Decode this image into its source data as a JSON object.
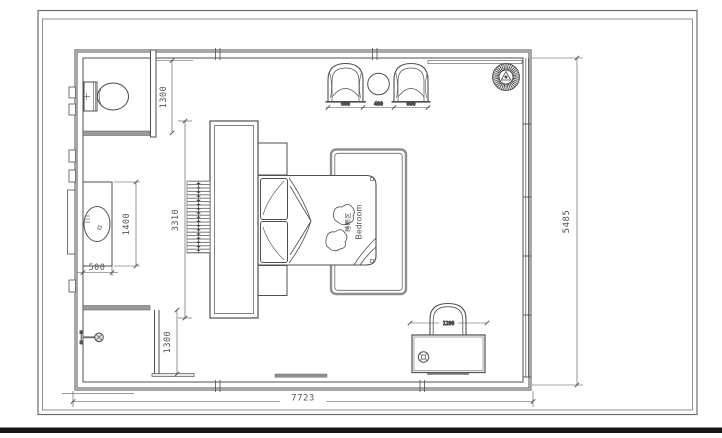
{
  "plan": {
    "room_label": {
      "zh": "睡眠区",
      "en": "Bedroom"
    },
    "dimensions": {
      "overall_width": "7723",
      "overall_height": "5485",
      "wc_depth": "1300",
      "shower_depth": "1300",
      "vanity_length": "1400",
      "vanity_depth": "500",
      "headboard_wall_length": "3310",
      "armchair_left_width": "600",
      "side_table_width": "400",
      "armchair_right_width": "600",
      "desk_width": "1200"
    },
    "colors": {
      "line": "#4f4f4f",
      "threshold": "#9a9a9a",
      "rug_border": "#8f8f8f",
      "bottom_bar": "#161616"
    }
  }
}
